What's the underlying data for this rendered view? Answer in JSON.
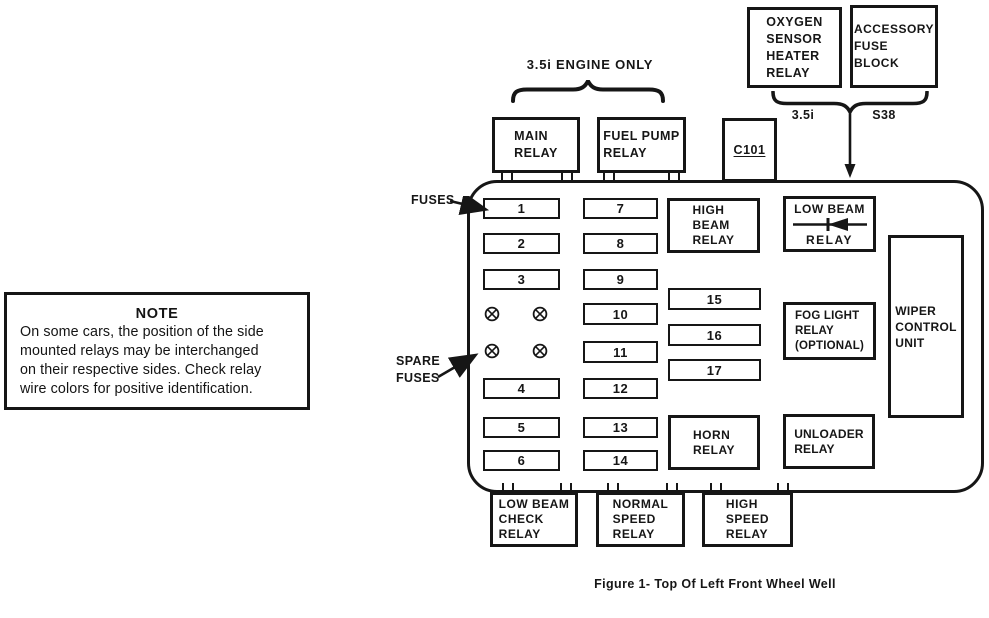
{
  "figure": {
    "caption": "Figure 1- Top Of Left Front Wheel Well"
  },
  "note": {
    "title": "NOTE",
    "body": "On some cars, the position of the side\nmounted relays may be interchanged\non their respective sides. Check relay\nwire colors for positive identification."
  },
  "annotations": {
    "engine_only": "3.5i ENGINE ONLY",
    "engine_35i": "3.5i",
    "s38": "S38",
    "fuses": "FUSES",
    "spare_fuses": "SPARE\nFUSES"
  },
  "external_boxes": {
    "main_relay": "MAIN\nRELAY",
    "fuel_pump_relay": "FUEL PUMP\nRELAY",
    "c101": "C101",
    "oxygen_sensor_heater_relay": "OXYGEN\nSENSOR\nHEATER\nRELAY",
    "accessory_fuse_block": "ACCESSORY\nFUSE\nBLOCK",
    "low_beam_check_relay": "LOW BEAM\nCHECK\nRELAY",
    "normal_speed_relay": "NORMAL\nSPEED\nRELAY",
    "high_speed_relay": "HIGH\nSPEED\nRELAY"
  },
  "internal_boxes": {
    "high_beam_relay": "HIGH\nBEAM\nRELAY",
    "low_beam_relay_line1": "LOW BEAM",
    "low_beam_relay_line2": "RELAY",
    "fog_light_relay": "FOG LIGHT\nRELAY\n(OPTIONAL)",
    "wiper_control_unit": "WIPER\nCONTROL\nUNIT",
    "horn_relay": "HORN\nRELAY",
    "unloader_relay": "UNLOADER\nRELAY"
  },
  "fuses": [
    "1",
    "2",
    "3",
    "4",
    "5",
    "6",
    "7",
    "8",
    "9",
    "10",
    "11",
    "12",
    "13",
    "14",
    "15",
    "16",
    "17"
  ],
  "colors": {
    "ink": "#161616",
    "paper": "#ffffff"
  }
}
